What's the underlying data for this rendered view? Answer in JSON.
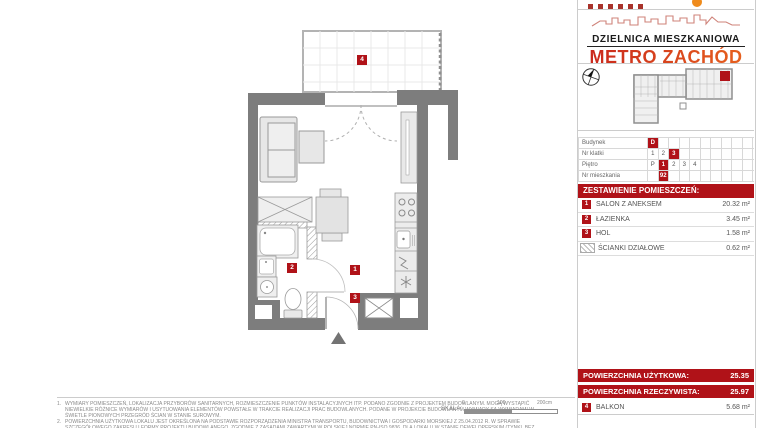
{
  "colors": {
    "red": "#b01218",
    "orange": "#ef8b1c",
    "brand_grad_from": "#c8241c",
    "brand_grad_to": "#e8641e",
    "wall": "#7d7d7d"
  },
  "brand": {
    "line1": "DZIELNICA MIESZKANIOWA",
    "line2": "METRO ZACHÓD"
  },
  "unit_table": {
    "rows": [
      {
        "label": "Budynek",
        "cells": [
          {
            "v": "D",
            "active": true
          },
          {},
          {},
          {},
          {},
          {},
          {},
          {},
          {},
          {}
        ]
      },
      {
        "label": "Nr klatki",
        "cells": [
          {
            "v": "1"
          },
          {
            "v": "2"
          },
          {
            "v": "3",
            "active": true
          },
          {},
          {},
          {},
          {},
          {},
          {},
          {}
        ]
      },
      {
        "label": "Piętro",
        "cells": [
          {
            "v": "P"
          },
          {
            "v": "1",
            "active": true
          },
          {
            "v": "2"
          },
          {
            "v": "3"
          },
          {
            "v": "4"
          },
          {},
          {},
          {},
          {},
          {}
        ]
      },
      {
        "label": "Nr mieszkania",
        "cells": [
          {},
          {
            "v": "92",
            "active": true
          },
          {},
          {},
          {},
          {},
          {},
          {},
          {},
          {}
        ]
      }
    ]
  },
  "rooms_header": "ZESTAWIENIE POMIESZCZEŃ:",
  "rooms": [
    {
      "num": "1",
      "name": "SALON Z ANEKSEM",
      "area": "20.32 m²"
    },
    {
      "num": "2",
      "name": "ŁAZIENKA",
      "area": "3.45 m²"
    },
    {
      "num": "3",
      "name": "HOL",
      "area": "1.58 m²"
    },
    {
      "swatch": true,
      "name": "ŚCIANKI DZIAŁOWE",
      "area": "0.62 m²"
    }
  ],
  "totals": {
    "uzytkowa_label": "POWIERZCHNIA UŻYTKOWA:",
    "uzytkowa_value": "25.35",
    "rzeczywista_label": "POWIERZCHNIA RZECZYWISTA:",
    "rzeczywista_value": "25.97"
  },
  "balkon": {
    "num": "4",
    "name": "BALKON",
    "area": "5.68 m²"
  },
  "plan_labels": {
    "salon": "1",
    "lazienka": "2",
    "hol": "3",
    "balkon": "4"
  },
  "scale": {
    "label": "SKALA:",
    "ticks": [
      "0",
      "100",
      "200cm"
    ]
  },
  "footnotes": [
    {
      "n": "1.",
      "text": "WYMIARY POMIESZCZEŃ, LOKALIZACJA PRZYBORÓW SANITARNYCH, ROZMIESZCZENIE PUNKTÓW INSTALACYJNYCH ITP. PODANO ZGODNIE Z PROJEKTEM BUDOWLANYM. MOGĄ WYSTĄPIĆ NIEWIELKIE RÓŻNICE WYMIARÓW I USYTUOWANIA ELEMENTÓW POWSTAŁE W TRAKCIE REALIZACJI PRAC BUDOWLANYCH. PODANE W PROJEKCIE BUDOWLANYM WYMIARY SĄ WYMIARAMI W ŚWIETLE PIONOWYCH PRZEGRÓD ŚCIAN W STANIE SUROWYM."
    },
    {
      "n": "2.",
      "text": "POWIERZCHNIA UŻYTKOWA LOKALU JEST OKREŚLONA NA PODSTAWIE ROZPORZĄDZENIA MINISTRA TRANSPORTU, BUDOWNICTWA I GOSPODARKI MORSKIEJ Z 25.04.2012 R. W SPRAWIE SZCZEGÓŁOWEGO ZAKRESU I FORMY PROJEKTU BUDOWLANEGO, ZGODNIE Z ZASADAMI ZAWARTYMI W POLSKIEJ NORMIE PN-ISO 9836, DLA LOKALU W STANIE DEWELOPERSKIM (TYNKI, BEZ WARSTW WYKOŃCZENIOWYCH)."
    }
  ]
}
